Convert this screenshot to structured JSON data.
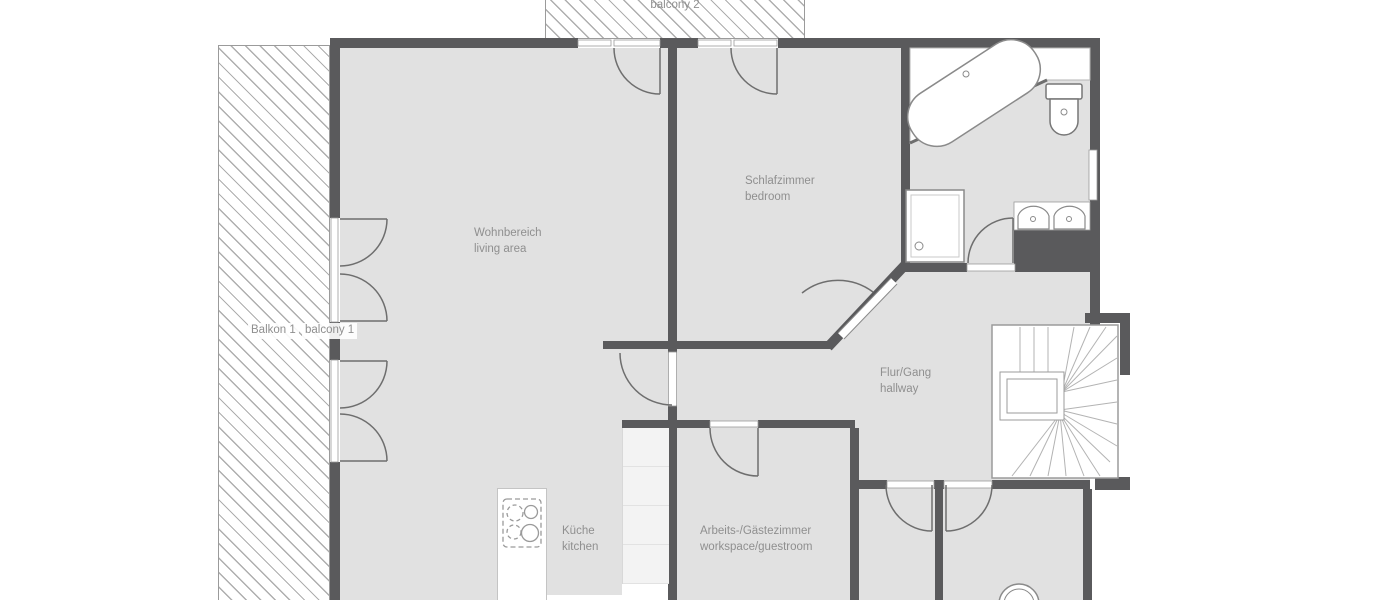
{
  "plan": {
    "type": "apartment-floor-plan",
    "rooms": {
      "balcony2": {
        "line2": "balcony 2"
      },
      "balcony1": {
        "line1": "Balkon 1",
        "line2": "balcony 1"
      },
      "living": {
        "line1": "Wohnbereich",
        "line2": "living area"
      },
      "bedroom": {
        "line1": "Schlafzimmer",
        "line2": "bedroom"
      },
      "hallway": {
        "line1": "Flur/Gang",
        "line2": "hallway"
      },
      "kitchen": {
        "line1": "Küche",
        "line2": "kitchen"
      },
      "workspace": {
        "line1": "Arbeits-/Gästezimmer",
        "line2": "workspace/guestroom"
      }
    },
    "fixtures": [
      "bathtub",
      "toilet",
      "shower",
      "double-washbasin",
      "staircase",
      "stove",
      "kitchen-cabinets",
      "washing-machine",
      "french-doors",
      "door-swing-arcs",
      "window",
      "balcony-hatching"
    ],
    "colors": {
      "wall": "#5a5a5c",
      "floor": "#e1e1e1",
      "hatch_line": "#aeaeae",
      "label_text": "#8f8f8f",
      "fixture_outline": "#8a8a8a",
      "counter": "#f3f3f3",
      "background": "#ffffff"
    }
  }
}
